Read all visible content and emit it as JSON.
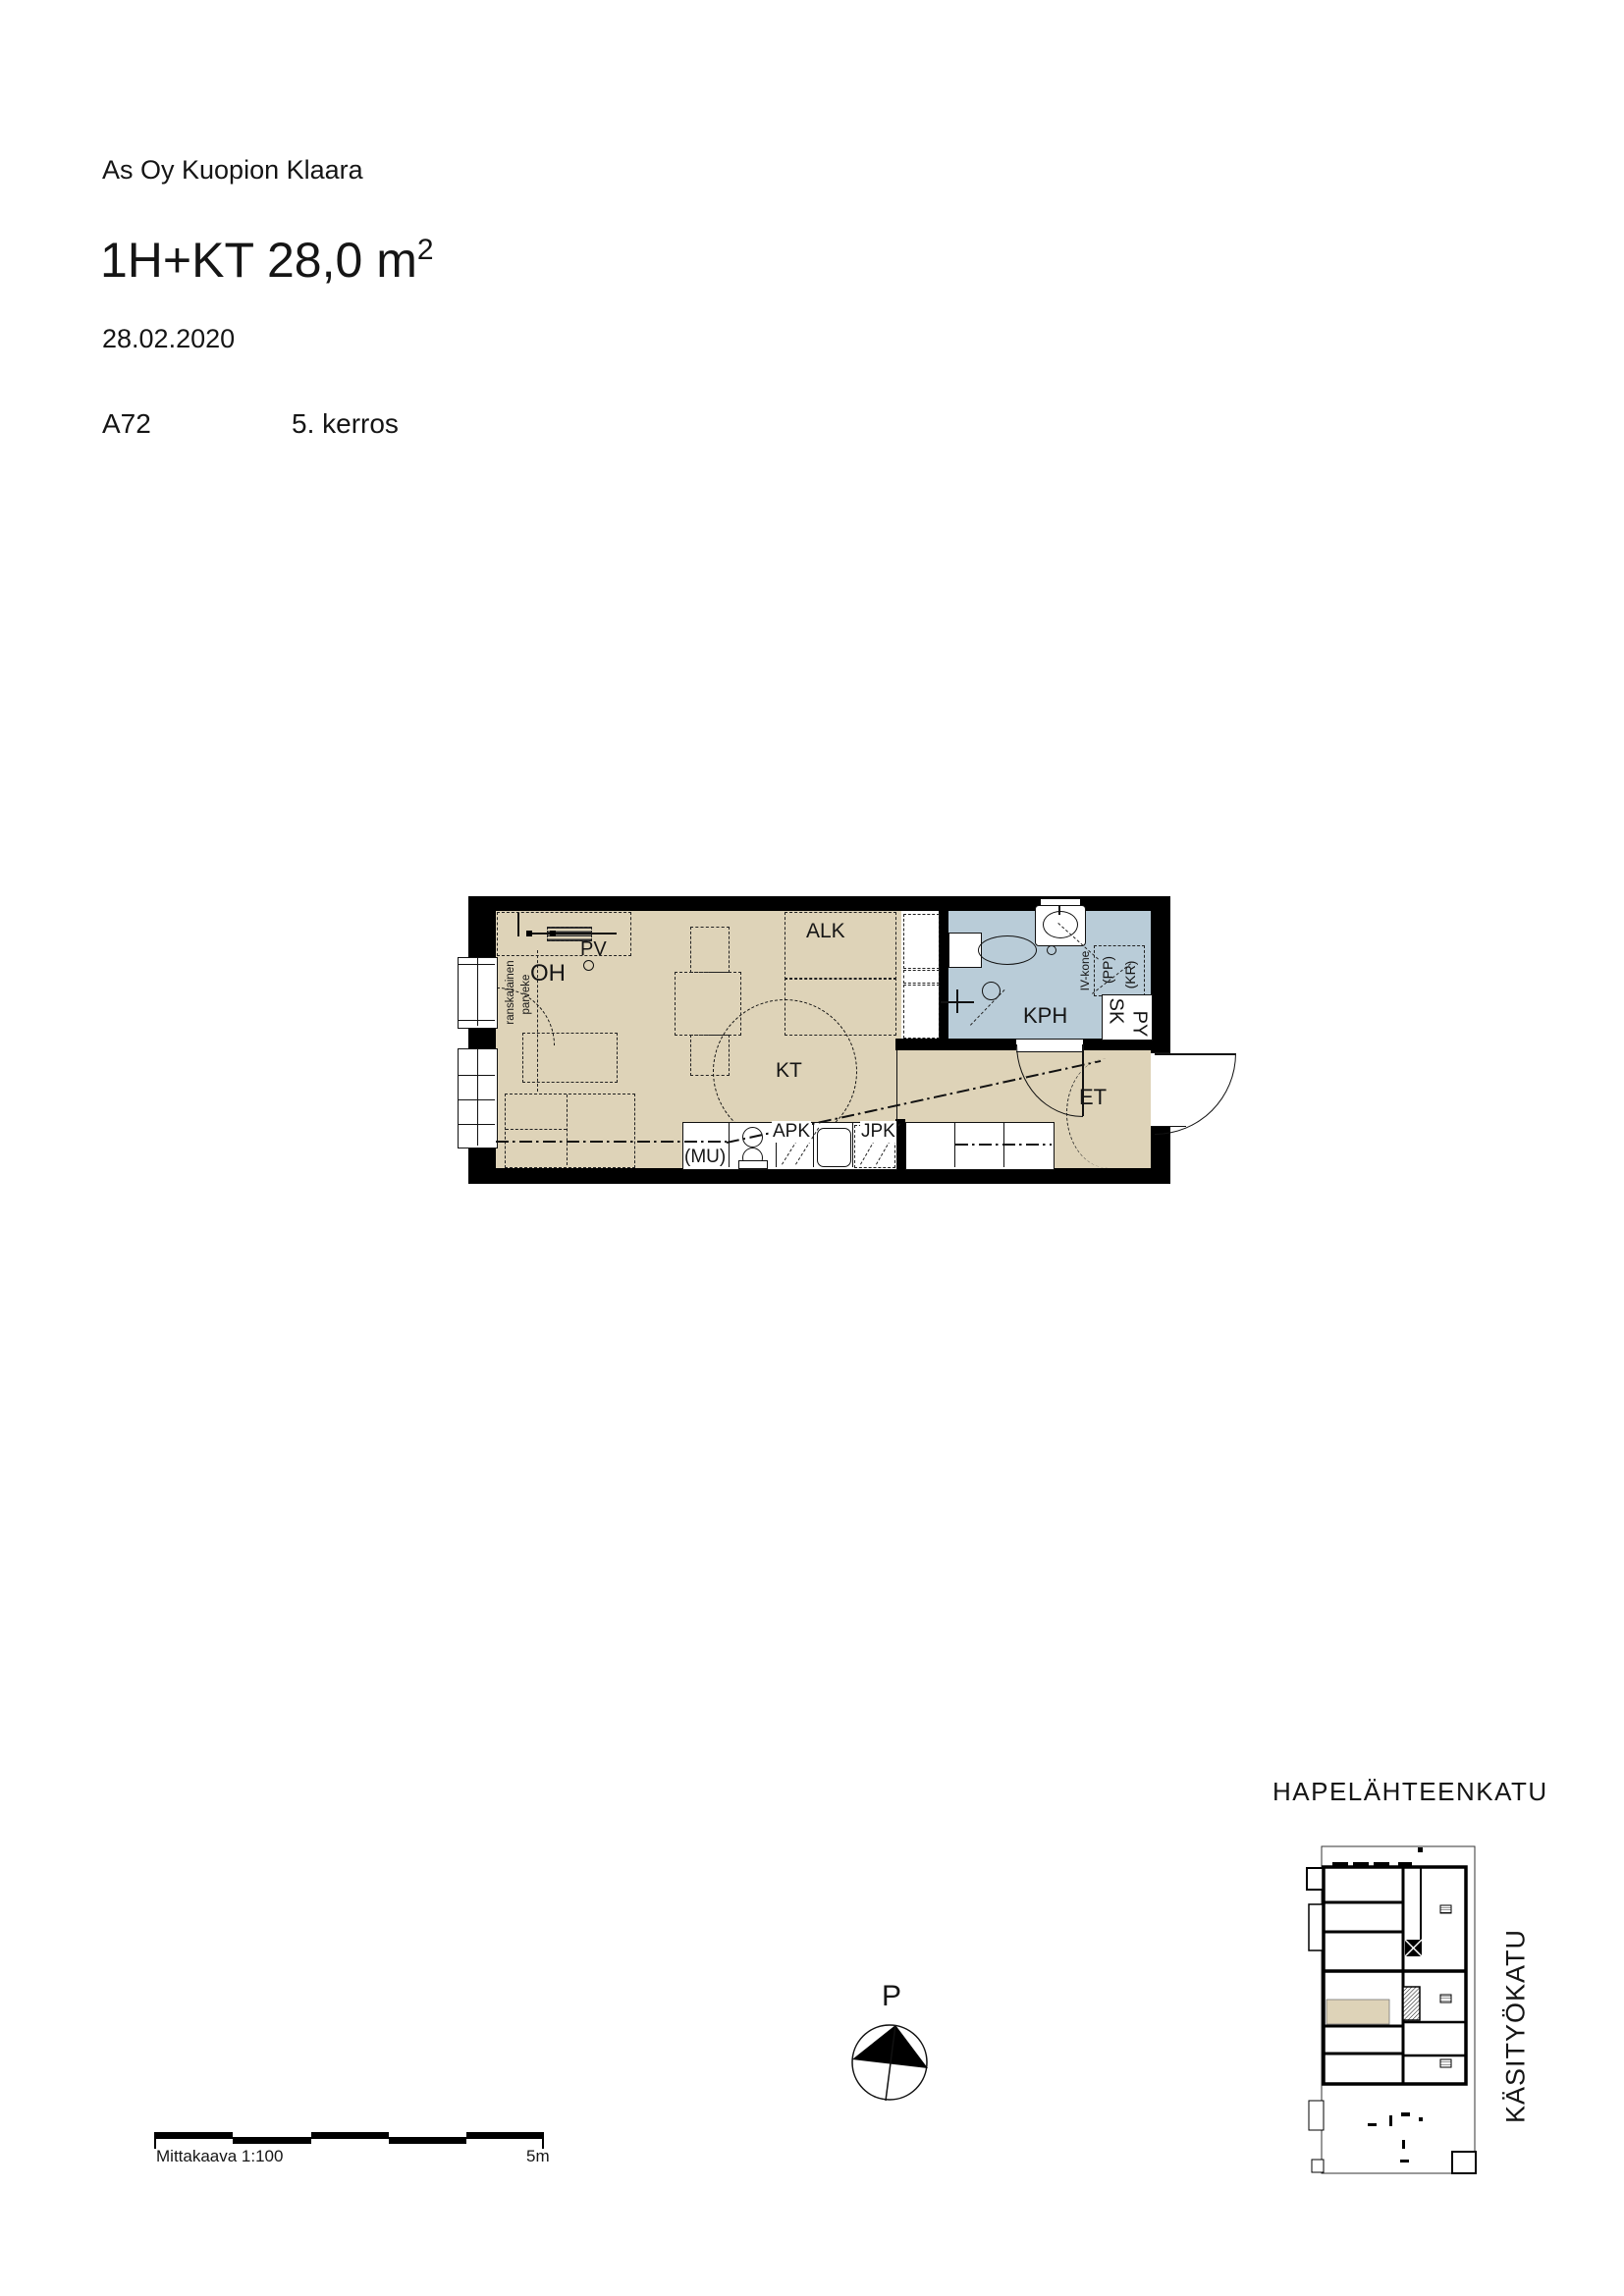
{
  "header": {
    "company": "As Oy Kuopion Klaara",
    "title_main": "1H+KT 28,0 m",
    "title_sup": "2",
    "date": "28.02.2020",
    "unit": "A72",
    "floor": "5. kerros"
  },
  "floorplan": {
    "labels": {
      "oh": "OH",
      "pv": "PV",
      "alk": "ALK",
      "kt": "KT",
      "kph": "KPH",
      "et": "ET",
      "apk": "APK",
      "jpk": "JPK",
      "mu": "(MU)",
      "sk": "SK",
      "py": "PY",
      "pp": "(PP)",
      "kr": "(KR)",
      "iv": "IV-kone",
      "balcony1": "ranskalainen",
      "balcony2": "parveke"
    }
  },
  "compass": {
    "label": "P"
  },
  "scalebar": {
    "caption": "Mittakaava 1:100",
    "end": "5m"
  },
  "siteplan": {
    "street_top": "HAPELÄHTEENKATU",
    "street_right": "KÄSITYÖKATU"
  },
  "colors": {
    "floor": "#ded3b8",
    "bath": "#b9ccd8",
    "wall": "#000000"
  }
}
